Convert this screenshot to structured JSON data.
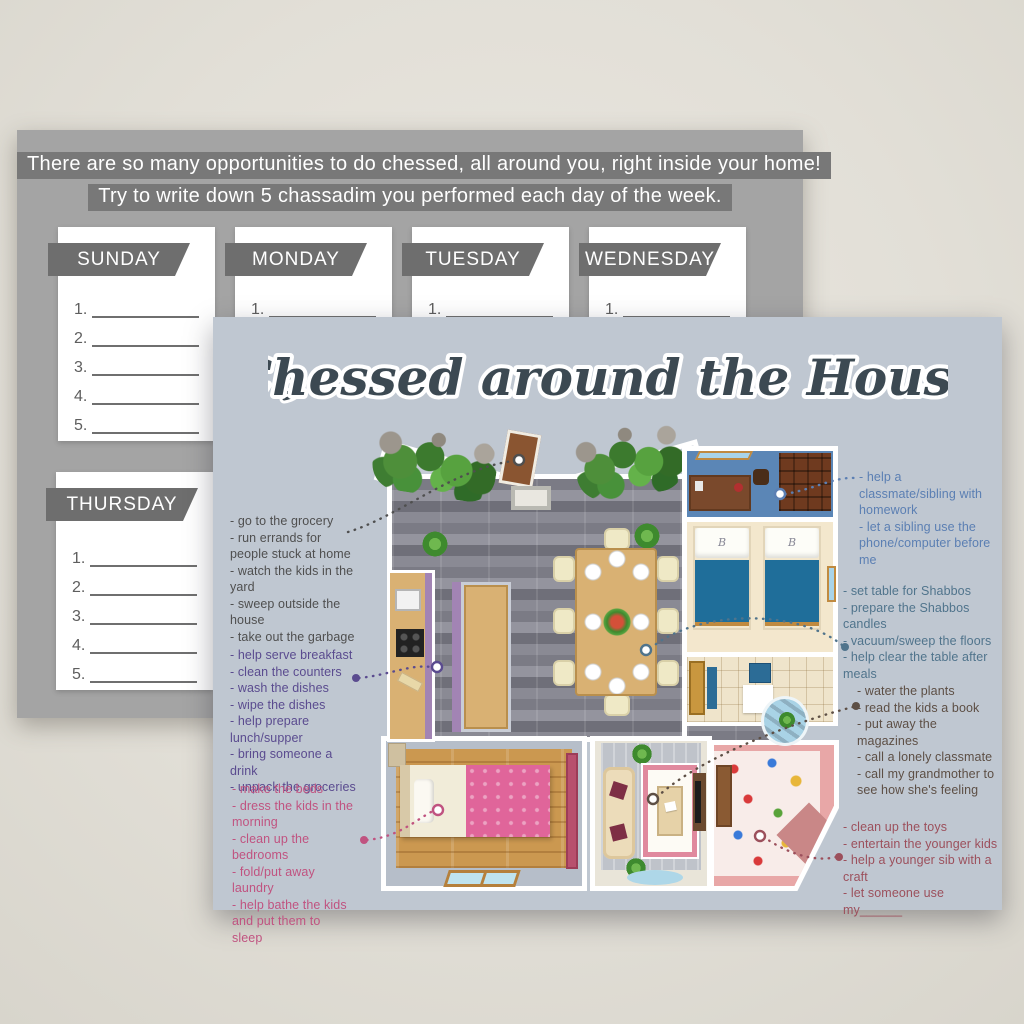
{
  "colors": {
    "page_bg": "#e5e2da",
    "back_card_bg": "#a4a4a4",
    "banner_bg": "#6e6e6e",
    "front_card_bg": "#bfc7d1",
    "title_color": "#3c4952"
  },
  "back_card": {
    "header": {
      "line1": "There are so many opportunities to do chessed, all around you, right inside your home!",
      "line2": "Try to write down 5 chassadim you performed each day of the week."
    },
    "days_row1": [
      "SUNDAY",
      "MONDAY",
      "TUESDAY",
      "WEDNESDAY"
    ],
    "days_row2": [
      "THURSDAY"
    ],
    "line_numbers": [
      "1.",
      "2.",
      "3.",
      "4.",
      "5."
    ]
  },
  "front_card": {
    "title": "Chessed around the House",
    "pillow_monogram": "B",
    "annotations": {
      "outdoor": {
        "color": "#4f4f4f",
        "items": [
          "- go to the grocery",
          "- run errands for people stuck at home",
          "- watch the kids in the yard",
          "- sweep outside the house",
          "- take out the garbage"
        ]
      },
      "kitchen": {
        "color": "#5a4b8f",
        "items": [
          "- help serve breakfast",
          "- clean the counters",
          "- wash the dishes",
          "- wipe the dishes",
          "- help prepare lunch/supper",
          "- bring someone a drink",
          "- unpack the groceries"
        ]
      },
      "bedroom": {
        "color": "#c05380",
        "items": [
          "- make the beds",
          "- dress the kids in the morning",
          "- clean up the bedrooms",
          "- fold/put away laundry",
          "- help bathe the kids and put them to sleep"
        ]
      },
      "study": {
        "color": "#5b7fb3",
        "items": [
          "- help a classmate/sibling with homework",
          "- let a sibling use the phone/computer before me"
        ]
      },
      "dining": {
        "color": "#50748c",
        "items": [
          "- set table for Shabbos",
          "- prepare the Shabbos candles",
          "- vacuum/sweep the floors",
          "- help clear the table after meals"
        ]
      },
      "living": {
        "color": "#5d4f45",
        "items": [
          "- water the plants",
          "- read the kids a book",
          "- put away the magazines",
          "- call a lonely classmate",
          "- call my grandmother to see how she's feeling"
        ]
      },
      "playroom": {
        "color": "#9c505c",
        "items": [
          "- clean up the toys",
          "- entertain the younger kids",
          "- help a younger sib with a craft",
          "- let someone use my______"
        ]
      }
    }
  }
}
